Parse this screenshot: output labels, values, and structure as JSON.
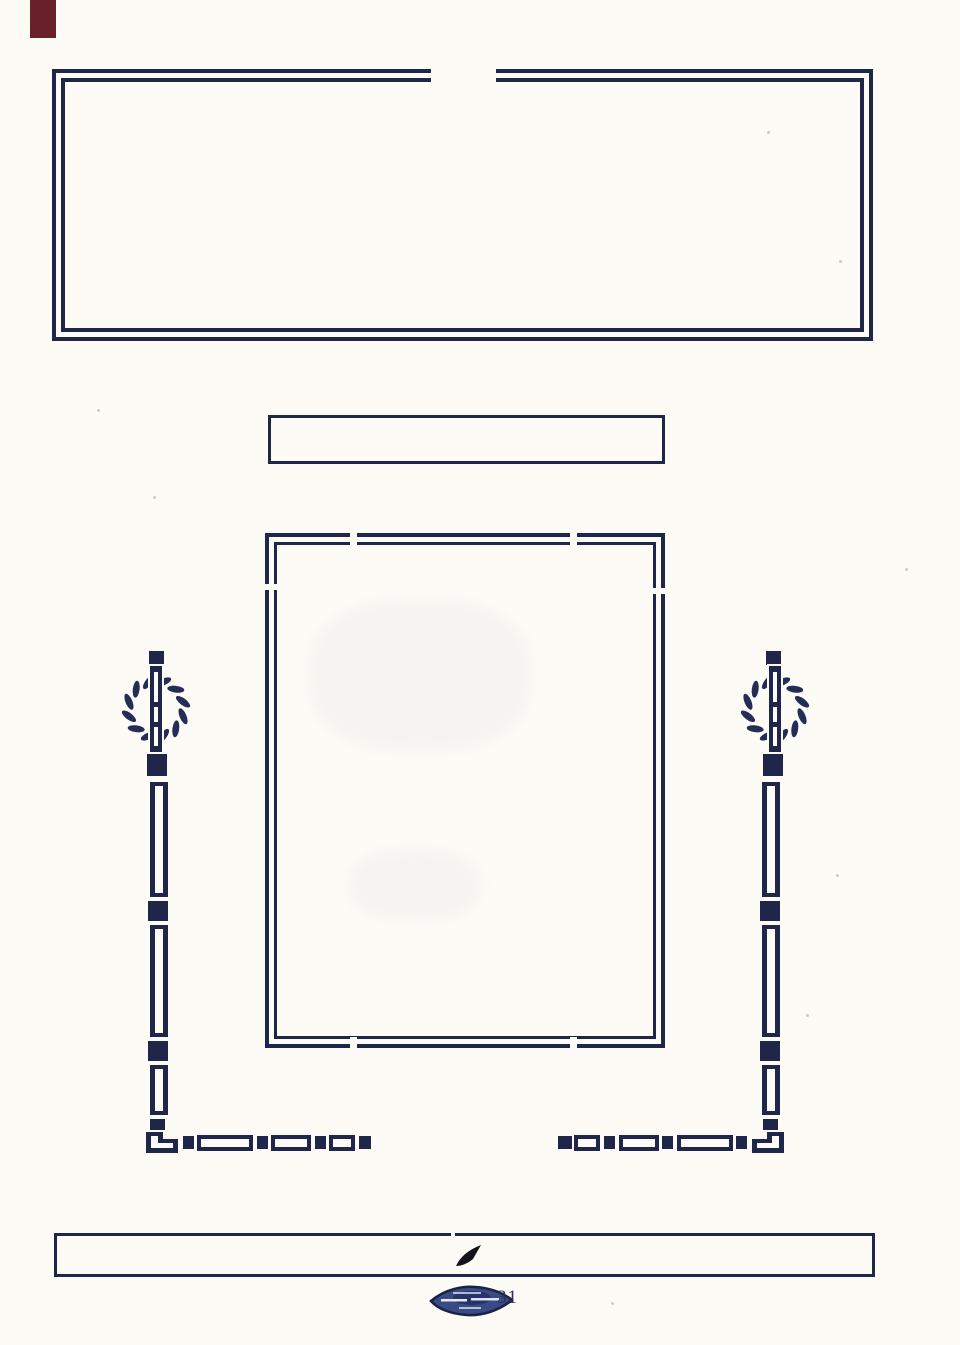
{
  "page": {
    "kind": "scanned blank printed form page",
    "paper_color": "#fcfbf6",
    "ink_color": "#1f2649",
    "red_mark_color": "#69202b"
  },
  "top_frame": {
    "content": ""
  },
  "title_box": {
    "content": ""
  },
  "center_frame": {
    "content": ""
  },
  "footer_rule_box": {
    "content": ""
  },
  "ornaments": {
    "left_icon": "wreath-and-staff-icon",
    "right_icon": "wreath-and-staff-icon",
    "chain_style_icon": "bar-and-bead-chain-icon"
  },
  "footer": {
    "union_label_icon": "printers-union-label-icon",
    "page_number": "31"
  }
}
